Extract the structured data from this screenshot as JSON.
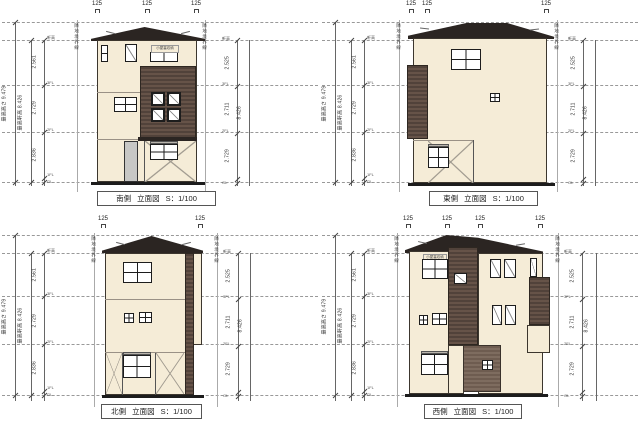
{
  "palette": {
    "wall_cream": "#f5ecd7",
    "siding_brown": "#57473c",
    "siding_brown_light": "#766455",
    "roof_dark": "#2b2522",
    "door_gray": "#c7c7c5",
    "line": "#333333"
  },
  "drawing": {
    "common": {
      "marker": "125",
      "boundary_label": "隣地境界線",
      "caption_type": "立面図",
      "caption_scale": "S：1/100",
      "attic_note": "小屋裏収納",
      "dims": {
        "total": "最高高さ 9.479",
        "eave": "最高軒高 8.426",
        "left_segments": [
          "2.561",
          "2.729",
          "2.836"
        ],
        "right_segments": [
          "2.525",
          "2.711",
          "2.729"
        ],
        "right_total": "8.426"
      },
      "levels": {
        "eave": "軒高",
        "f3": "3FL",
        "f2": "2FL",
        "f1": "1FL",
        "gl": "GL"
      }
    },
    "elevations": [
      {
        "name": "南側"
      },
      {
        "name": "東側"
      },
      {
        "name": "北側"
      },
      {
        "name": "西側"
      }
    ]
  }
}
